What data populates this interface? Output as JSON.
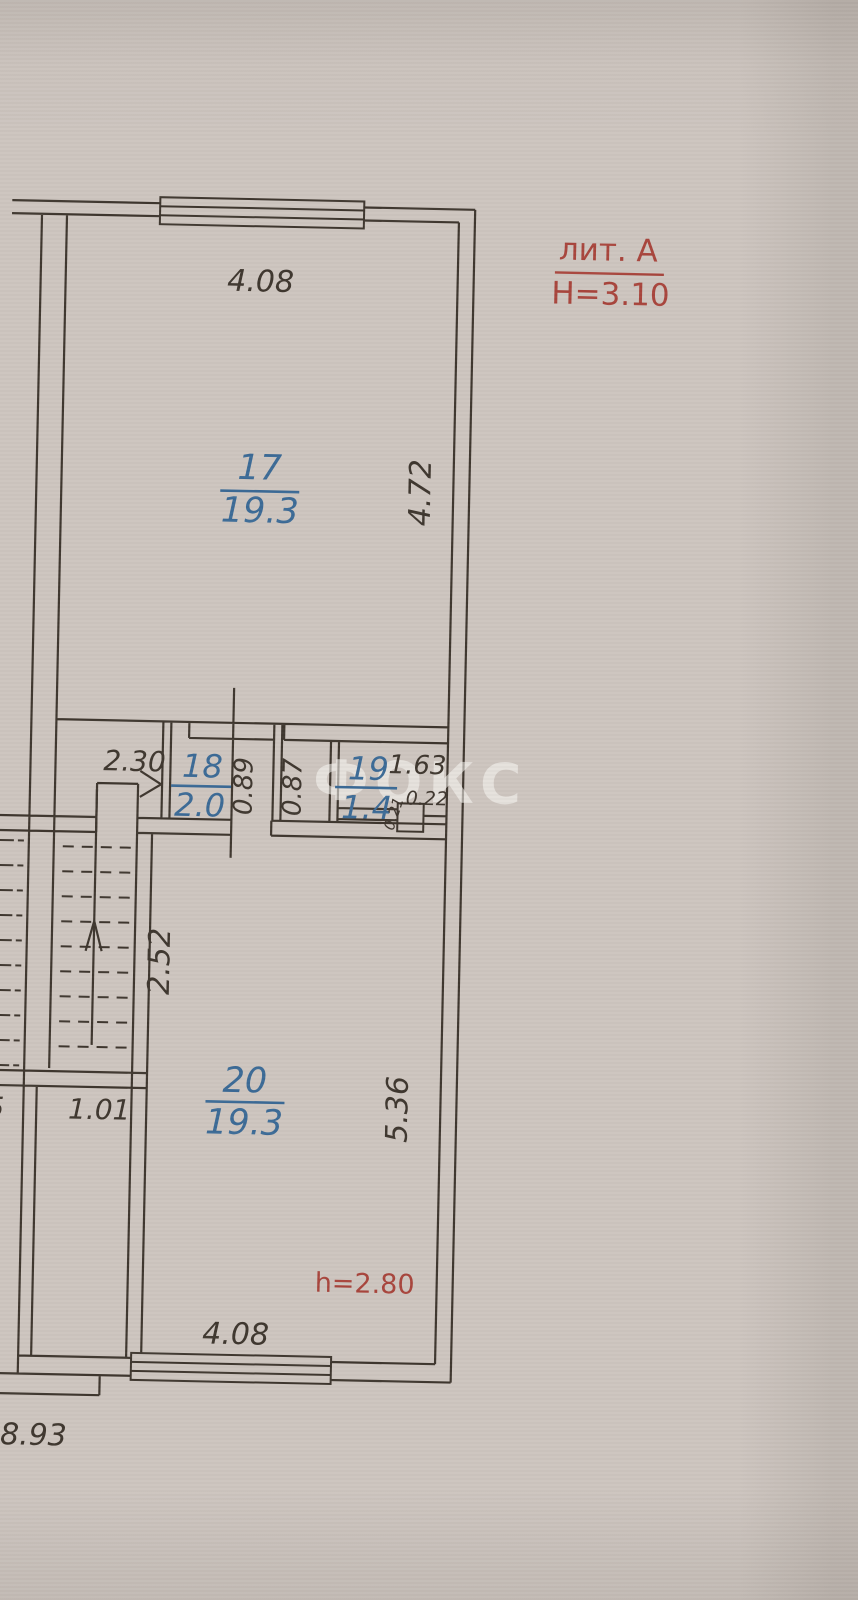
{
  "document": {
    "kind": "BTI floor plan scan",
    "paper_color": "#cdc5bf",
    "ink_color": "#3e362e",
    "room_label_color": "#3b6a96",
    "annotation_color": "#a8453c"
  },
  "annotation": {
    "liter": "лит. А",
    "building_height": "Н=3.10",
    "ceiling_height": "h=2.80"
  },
  "watermark": {
    "text": "ФОКС"
  },
  "rooms": [
    {
      "number": "17",
      "area": "19.3"
    },
    {
      "number": "18",
      "area": "2.0"
    },
    {
      "number": "19",
      "area": "1.4"
    },
    {
      "number": "20",
      "area": "19.3"
    }
  ],
  "dimensions": {
    "top_width": "4.08",
    "room17_depth": "4.72",
    "corridor_width": "2.30",
    "shaft_a": "0.89",
    "shaft_b": "0.87",
    "room19_width": "1.63",
    "notch_width": "0.22",
    "notch_depth": "0.21",
    "stair_depth": "2.52",
    "stair_exit_width": "1.01",
    "left_cut_digit": "5",
    "room20_depth": "5.36",
    "bottom_width": "4.08",
    "overall_width": "8.93"
  }
}
